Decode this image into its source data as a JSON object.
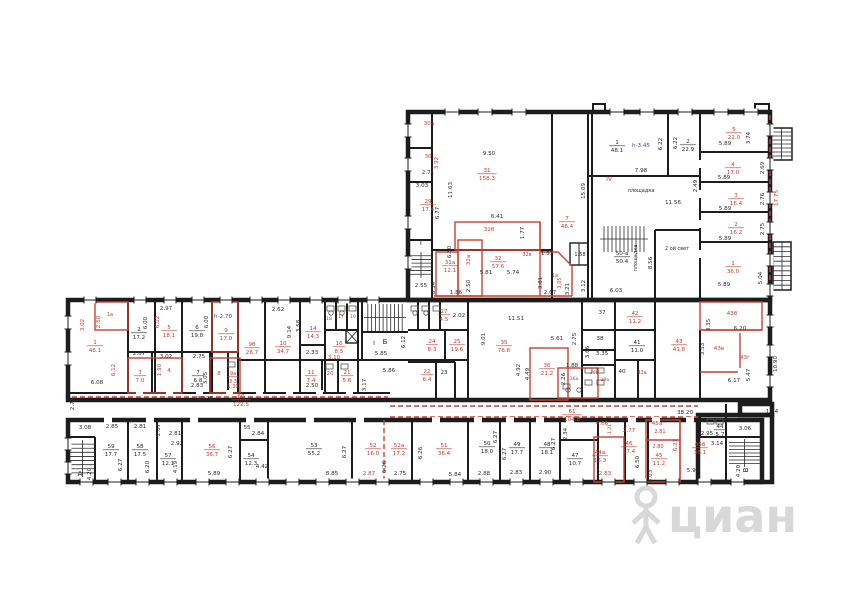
{
  "watermark": {
    "text": "циан"
  },
  "colors": {
    "ink": "#2b2b2b",
    "red": "#c23b2e",
    "blue": "#3f3fbf",
    "wall": "#1d1d1d",
    "watermark": "#d4d4d4"
  },
  "labels": [
    {
      "t": "30а",
      "x": 429,
      "y": 125,
      "c": "r"
    },
    {
      "t": "30",
      "x": 428,
      "y": 158,
      "c": "r"
    },
    {
      "t": "2.71",
      "x": 428,
      "y": 174
    },
    {
      "t": "3.92",
      "x": 438,
      "y": 163,
      "v": 1,
      "c": "r"
    },
    {
      "t": "3.03",
      "x": 422,
      "y": 187
    },
    {
      "t": "29",
      "a": "17.4",
      "x": 428,
      "y": 203,
      "c": "r"
    },
    {
      "t": "11.63",
      "x": 452,
      "y": 190,
      "v": 1
    },
    {
      "t": "6.77",
      "x": 439,
      "y": 213,
      "v": 1
    },
    {
      "t": "Г",
      "x": 422,
      "y": 245,
      "fs": 7
    },
    {
      "t": "6.50",
      "x": 451,
      "y": 252,
      "v": 1
    },
    {
      "t": "6.34",
      "x": 435,
      "y": 288,
      "v": 1
    },
    {
      "t": "2.55",
      "x": 421,
      "y": 287
    },
    {
      "t": "9.50",
      "x": 489,
      "y": 155
    },
    {
      "t": "31",
      "a": "158.3",
      "x": 487,
      "y": 172,
      "c": "r"
    },
    {
      "t": "32б",
      "x": 489,
      "y": 231,
      "c": "r"
    },
    {
      "t": "6.41",
      "x": 497,
      "y": 218
    },
    {
      "t": "1.77",
      "x": 524,
      "y": 233,
      "v": 1
    },
    {
      "t": "32а",
      "x": 470,
      "y": 260,
      "v": 1,
      "c": "r"
    },
    {
      "t": "31а",
      "a": "12.1",
      "x": 450,
      "y": 264,
      "c": "r"
    },
    {
      "t": "32",
      "a": "57.6",
      "x": 498,
      "y": 260,
      "c": "r"
    },
    {
      "t": "32в",
      "x": 527,
      "y": 256,
      "c": "r",
      "fs": 5
    },
    {
      "t": "5.81",
      "x": 486,
      "y": 274
    },
    {
      "t": "5.74",
      "x": 513,
      "y": 274
    },
    {
      "t": "2.50",
      "x": 470,
      "y": 286,
      "v": 1
    },
    {
      "t": "1.86",
      "x": 456,
      "y": 294
    },
    {
      "t": "1.31",
      "x": 547,
      "y": 255
    },
    {
      "t": "3.81",
      "x": 542,
      "y": 283,
      "v": 1
    },
    {
      "t": "2.67",
      "x": 550,
      "y": 294
    },
    {
      "t": "3.21",
      "x": 569,
      "y": 289,
      "v": 1
    },
    {
      "t": "1а",
      "x": 555,
      "y": 277,
      "c": "r",
      "fs": 5
    },
    {
      "t": "3.05",
      "x": 561,
      "y": 283,
      "v": 1,
      "c": "r",
      "fs": 5
    },
    {
      "t": "7",
      "a": "46.4",
      "x": 567,
      "y": 220,
      "c": "r"
    },
    {
      "t": "15.09",
      "x": 585,
      "y": 191,
      "v": 1
    },
    {
      "t": "1.58",
      "x": 580,
      "y": 256,
      "fs": 5
    },
    {
      "t": "3.12",
      "x": 585,
      "y": 286,
      "v": 1
    },
    {
      "t": "1",
      "a": "48.1",
      "x": 617,
      "y": 144
    },
    {
      "t": "h-3.45",
      "x": 641,
      "y": 147,
      "c": "b"
    },
    {
      "t": "6.22",
      "x": 662,
      "y": 144,
      "v": 1
    },
    {
      "t": "6.22",
      "x": 677,
      "y": 143,
      "v": 1
    },
    {
      "t": "2",
      "a": "22.9",
      "x": 688,
      "y": 143
    },
    {
      "t": "7.98",
      "x": 641,
      "y": 172
    },
    {
      "t": "IV",
      "x": 609,
      "y": 181,
      "c": "r",
      "fs": 6
    },
    {
      "t": "площадка",
      "x": 641,
      "y": 192,
      "fs": 5
    },
    {
      "t": "11.56",
      "x": 673,
      "y": 204
    },
    {
      "t": "2.49",
      "x": 697,
      "y": 186,
      "v": 1
    },
    {
      "t": "50-а",
      "a": "50.4",
      "x": 622,
      "y": 255
    },
    {
      "t": "площадка",
      "x": 637,
      "y": 258,
      "v": 1,
      "fs": 5
    },
    {
      "t": "8.56",
      "x": 652,
      "y": 263,
      "v": 1
    },
    {
      "t": "2 ой свет",
      "x": 677,
      "y": 250,
      "fs": 5
    },
    {
      "t": "6.03",
      "x": 616,
      "y": 292
    },
    {
      "t": "1",
      "a": "36.0",
      "x": 733,
      "y": 265,
      "c": "r"
    },
    {
      "t": "5.89",
      "x": 724,
      "y": 286
    },
    {
      "t": "5.04",
      "x": 762,
      "y": 278,
      "v": 1
    },
    {
      "t": "5",
      "a": "22.0",
      "x": 734,
      "y": 131,
      "c": "r"
    },
    {
      "t": "5.89",
      "x": 725,
      "y": 145
    },
    {
      "t": "3.74",
      "x": 750,
      "y": 138,
      "v": 1
    },
    {
      "t": "4",
      "a": "17.0",
      "x": 733,
      "y": 166,
      "c": "r"
    },
    {
      "t": "5.89",
      "x": 724,
      "y": 179
    },
    {
      "t": "2.69",
      "x": 764,
      "y": 168,
      "v": 1
    },
    {
      "t": "3",
      "a": "16.4",
      "x": 736,
      "y": 197,
      "c": "r"
    },
    {
      "t": "5.89",
      "x": 725,
      "y": 210
    },
    {
      "t": "2.76",
      "x": 764,
      "y": 199,
      "v": 1
    },
    {
      "t": "2",
      "a": "16.2",
      "x": 736,
      "y": 226,
      "c": "r"
    },
    {
      "t": "5.89",
      "x": 725,
      "y": 240
    },
    {
      "t": "2.75",
      "x": 764,
      "y": 229,
      "v": 1
    },
    {
      "t": "17.75",
      "x": 778,
      "y": 198,
      "v": 1,
      "c": "r"
    },
    {
      "t": "1а",
      "x": 110,
      "y": 316,
      "c": "r",
      "fs": 5
    },
    {
      "t": "3.02",
      "x": 84,
      "y": 325,
      "v": 1,
      "c": "r"
    },
    {
      "t": "2.50",
      "x": 100,
      "y": 322,
      "v": 1,
      "c": "r"
    },
    {
      "t": "1",
      "a": "46.1",
      "x": 95,
      "y": 344,
      "c": "r"
    },
    {
      "t": "2.97",
      "x": 166,
      "y": 310
    },
    {
      "t": "2",
      "a": "17.2",
      "x": 139,
      "y": 331
    },
    {
      "t": "6.00",
      "x": 147,
      "y": 323,
      "v": 1
    },
    {
      "t": "5",
      "a": "18.1",
      "x": 169,
      "y": 329,
      "c": "r"
    },
    {
      "t": "6.02",
      "x": 159,
      "y": 322,
      "v": 1,
      "c": "r"
    },
    {
      "t": "6",
      "a": "19.8",
      "x": 197,
      "y": 329
    },
    {
      "t": "6.00",
      "x": 208,
      "y": 322,
      "v": 1
    },
    {
      "t": "9",
      "a": "17.0",
      "x": 226,
      "y": 332,
      "c": "r"
    },
    {
      "t": "h-2.70",
      "x": 223,
      "y": 318,
      "c": "b"
    },
    {
      "t": "2.87",
      "x": 139,
      "y": 355
    },
    {
      "t": "3.02",
      "x": 166,
      "y": 358
    },
    {
      "t": "2.75",
      "x": 199,
      "y": 358
    },
    {
      "t": "6.12",
      "x": 115,
      "y": 370,
      "v": 1,
      "c": "r"
    },
    {
      "t": "3",
      "a": "7.0",
      "x": 140,
      "y": 374,
      "c": "r"
    },
    {
      "t": "4",
      "x": 169,
      "y": 372,
      "c": "r"
    },
    {
      "t": "1.90",
      "x": 161,
      "y": 370,
      "v": 1,
      "c": "r"
    },
    {
      "t": "7",
      "a": "6.8",
      "x": 198,
      "y": 374
    },
    {
      "t": "2.83",
      "x": 197,
      "y": 387
    },
    {
      "t": "3.05",
      "x": 207,
      "y": 378,
      "v": 1
    },
    {
      "t": "8",
      "x": 219,
      "y": 375,
      "c": "r"
    },
    {
      "t": "9а",
      "a": "3.3",
      "x": 233,
      "y": 375,
      "c": "r",
      "fs": 5
    },
    {
      "t": "1.30",
      "x": 233,
      "y": 388,
      "c": "r",
      "fs": 5
    },
    {
      "t": "6.08",
      "x": 97,
      "y": 384
    },
    {
      "t": "30.26",
      "x": 205,
      "y": 400
    },
    {
      "t": "2.71",
      "x": 74,
      "y": 404,
      "v": 1
    },
    {
      "t": "60",
      "a": "122.5",
      "x": 241,
      "y": 398,
      "c": "r"
    },
    {
      "t": "9б",
      "a": "26.7",
      "x": 252,
      "y": 346,
      "c": "r"
    },
    {
      "t": "10",
      "a": "34.7",
      "x": 283,
      "y": 345,
      "c": "r"
    },
    {
      "t": "2.62",
      "x": 278,
      "y": 311
    },
    {
      "t": "9.14",
      "x": 291,
      "y": 332,
      "v": 1
    },
    {
      "t": "3.58",
      "x": 300,
      "y": 326,
      "v": 1
    },
    {
      "t": "14",
      "a": "14.3",
      "x": 313,
      "y": 330,
      "c": "r"
    },
    {
      "t": "18",
      "x": 329,
      "y": 320,
      "c": "r",
      "fs": 4.5
    },
    {
      "t": "17",
      "x": 341,
      "y": 318,
      "c": "r",
      "fs": 4.5
    },
    {
      "t": "19",
      "x": 353,
      "y": 318,
      "c": "r",
      "fs": 4.5
    },
    {
      "t": "16",
      "a": "8.5",
      "x": 339,
      "y": 345,
      "c": "r"
    },
    {
      "t": "2.33",
      "x": 312,
      "y": 354
    },
    {
      "t": "3.10",
      "x": 334,
      "y": 359,
      "c": "r"
    },
    {
      "t": "11",
      "a": "7.4",
      "x": 311,
      "y": 374,
      "c": "r"
    },
    {
      "t": "2.50",
      "x": 312,
      "y": 387
    },
    {
      "t": "20",
      "x": 330,
      "y": 375,
      "c": "r"
    },
    {
      "t": "21",
      "a": "5.6",
      "x": 347,
      "y": 374,
      "c": "r"
    },
    {
      "t": "Б",
      "x": 385,
      "y": 344,
      "fs": 7
    },
    {
      "t": "I",
      "x": 374,
      "y": 345,
      "fs": 6
    },
    {
      "t": "6.12",
      "x": 405,
      "y": 342,
      "v": 1
    },
    {
      "t": "5.85",
      "x": 381,
      "y": 355
    },
    {
      "t": "5.86",
      "x": 389,
      "y": 372
    },
    {
      "t": "3.17",
      "x": 366,
      "y": 385,
      "v": 1
    },
    {
      "t": "27",
      "a": "4.5",
      "x": 444,
      "y": 313,
      "c": "r"
    },
    {
      "t": "2.02",
      "x": 459,
      "y": 317
    },
    {
      "t": "24",
      "a": "8.3",
      "x": 432,
      "y": 343,
      "c": "r"
    },
    {
      "t": "25",
      "a": "19.6",
      "x": 457,
      "y": 343,
      "c": "r"
    },
    {
      "t": "22",
      "a": "6.4",
      "x": 427,
      "y": 373,
      "c": "r"
    },
    {
      "t": "23",
      "x": 444,
      "y": 374
    },
    {
      "t": "35",
      "a": "76.8",
      "x": 504,
      "y": 344,
      "c": "r"
    },
    {
      "t": "11.51",
      "x": 516,
      "y": 320
    },
    {
      "t": "9.01",
      "x": 485,
      "y": 339,
      "v": 1
    },
    {
      "t": "5.61",
      "x": 557,
      "y": 340
    },
    {
      "t": "2.75",
      "x": 576,
      "y": 339,
      "v": 1
    },
    {
      "t": "37",
      "x": 602,
      "y": 314
    },
    {
      "t": "38",
      "x": 600,
      "y": 340
    },
    {
      "t": "3.66",
      "x": 589,
      "y": 352,
      "v": 1
    },
    {
      "t": "3.35",
      "x": 602,
      "y": 355
    },
    {
      "t": "36",
      "a": "21.2",
      "x": 547,
      "y": 367,
      "c": "r"
    },
    {
      "t": "4.92",
      "x": 520,
      "y": 370,
      "v": 1
    },
    {
      "t": "4.49",
      "x": 529,
      "y": 374,
      "v": 1
    },
    {
      "t": "1.88",
      "x": 572,
      "y": 367
    },
    {
      "t": "2.26",
      "x": 565,
      "y": 379,
      "v": 1
    },
    {
      "t": "36а",
      "x": 574,
      "y": 380,
      "c": "r",
      "fs": 4.5
    },
    {
      "t": "36б",
      "x": 594,
      "y": 374,
      "c": "r",
      "fs": 4.5
    },
    {
      "t": "39а",
      "x": 605,
      "y": 381,
      "c": "r",
      "fs": 4.5
    },
    {
      "t": "40",
      "x": 622,
      "y": 373
    },
    {
      "t": "41",
      "a": "11.0",
      "x": 637,
      "y": 344
    },
    {
      "t": "42",
      "a": "11.2",
      "x": 635,
      "y": 315,
      "c": "r"
    },
    {
      "t": "43",
      "a": "41.8",
      "x": 679,
      "y": 343,
      "c": "r"
    },
    {
      "t": "43а",
      "x": 642,
      "y": 374,
      "c": "r",
      "fs": 5
    },
    {
      "t": "43б",
      "x": 732,
      "y": 315,
      "c": "r"
    },
    {
      "t": "3.35",
      "x": 710,
      "y": 325,
      "v": 1
    },
    {
      "t": "6.20",
      "x": 740,
      "y": 330
    },
    {
      "t": "43в",
      "x": 719,
      "y": 350,
      "c": "r"
    },
    {
      "t": "3.53",
      "x": 704,
      "y": 349,
      "v": 1
    },
    {
      "t": "43г",
      "x": 745,
      "y": 359,
      "c": "r"
    },
    {
      "t": "6.17",
      "x": 734,
      "y": 382
    },
    {
      "t": "5.47",
      "x": 750,
      "y": 375,
      "v": 1
    },
    {
      "t": "10.90",
      "x": 777,
      "y": 364,
      "v": 1
    },
    {
      "t": "61",
      "a": "104.8",
      "x": 572,
      "y": 413,
      "c": "r"
    },
    {
      "t": "38.20",
      "x": 685,
      "y": 414
    },
    {
      "t": "1.54",
      "x": 772,
      "y": 413
    },
    {
      "t": "3.08",
      "x": 85,
      "y": 429
    },
    {
      "t": "2.85",
      "x": 112,
      "y": 428
    },
    {
      "t": "2.81",
      "x": 140,
      "y": 428
    },
    {
      "t": "2.07",
      "x": 160,
      "y": 430,
      "v": 1
    },
    {
      "t": "2.81",
      "x": 175,
      "y": 435
    },
    {
      "t": "2.92",
      "x": 177,
      "y": 445
    },
    {
      "t": "А",
      "x": 80,
      "y": 476,
      "fs": 7
    },
    {
      "t": "4.20",
      "x": 91,
      "y": 474,
      "v": 1
    },
    {
      "t": "59",
      "a": "17.7",
      "x": 111,
      "y": 448
    },
    {
      "t": "6.27",
      "x": 122,
      "y": 465,
      "v": 1
    },
    {
      "t": "58",
      "a": "17.5",
      "x": 140,
      "y": 448
    },
    {
      "t": "6.20",
      "x": 149,
      "y": 467,
      "v": 1
    },
    {
      "t": "57",
      "a": "12.1",
      "x": 168,
      "y": 457
    },
    {
      "t": "4.19",
      "x": 177,
      "y": 467,
      "v": 1
    },
    {
      "t": "56",
      "a": "36.7",
      "x": 212,
      "y": 448,
      "c": "r"
    },
    {
      "t": "6.27",
      "x": 232,
      "y": 452,
      "v": 1
    },
    {
      "t": "5.89",
      "x": 214,
      "y": 475
    },
    {
      "t": "55",
      "x": 247,
      "y": 429
    },
    {
      "t": "2.84",
      "x": 258,
      "y": 435
    },
    {
      "t": "54",
      "a": "12.3",
      "x": 251,
      "y": 457
    },
    {
      "t": "4.42",
      "x": 262,
      "y": 468
    },
    {
      "t": "53",
      "a": "55.2",
      "x": 314,
      "y": 447
    },
    {
      "t": "6.27",
      "x": 346,
      "y": 452,
      "v": 1
    },
    {
      "t": "8.85",
      "x": 332,
      "y": 475
    },
    {
      "t": "52",
      "a": "16.0",
      "x": 373,
      "y": 447,
      "c": "r"
    },
    {
      "t": "52а",
      "a": "17.2",
      "x": 399,
      "y": 447,
      "c": "r"
    },
    {
      "t": "6.26",
      "x": 386,
      "y": 467,
      "v": 1
    },
    {
      "t": "2.87",
      "x": 369,
      "y": 475,
      "c": "r"
    },
    {
      "t": "2.75",
      "x": 400,
      "y": 475
    },
    {
      "t": "51",
      "a": "36.4",
      "x": 444,
      "y": 447,
      "c": "r"
    },
    {
      "t": "6.26",
      "x": 422,
      "y": 453,
      "v": 1
    },
    {
      "t": "5.84",
      "x": 455,
      "y": 476
    },
    {
      "t": "50",
      "a": "18.0",
      "x": 487,
      "y": 445
    },
    {
      "t": "6.27",
      "x": 497,
      "y": 437,
      "v": 1
    },
    {
      "t": "2.88",
      "x": 484,
      "y": 475
    },
    {
      "t": "49",
      "a": "17.7",
      "x": 517,
      "y": 446
    },
    {
      "t": "6.27",
      "x": 506,
      "y": 454,
      "v": 1
    },
    {
      "t": "2.83",
      "x": 516,
      "y": 474
    },
    {
      "t": "48",
      "a": "18.1",
      "x": 547,
      "y": 446
    },
    {
      "t": "6.27",
      "x": 555,
      "y": 444,
      "v": 1
    },
    {
      "t": "2.90",
      "x": 545,
      "y": 474
    },
    {
      "t": "2.34",
      "x": 567,
      "y": 434,
      "v": 1
    },
    {
      "t": "47",
      "a": "10.7",
      "x": 575,
      "y": 457
    },
    {
      "t": "4.66",
      "x": 602,
      "y": 425,
      "c": "r"
    },
    {
      "t": "1.21",
      "x": 611,
      "y": 429,
      "v": 1,
      "c": "r",
      "fs": 4.5
    },
    {
      "t": "2.77",
      "x": 629,
      "y": 432,
      "c": "r"
    },
    {
      "t": "44а",
      "a": "13.3",
      "x": 600,
      "y": 454,
      "c": "r"
    },
    {
      "t": "2.83",
      "x": 605,
      "y": 475,
      "c": "r"
    },
    {
      "t": "46",
      "a": "17.4",
      "x": 629,
      "y": 445,
      "c": "r"
    },
    {
      "t": "6.50",
      "x": 639,
      "y": 462,
      "v": 1
    },
    {
      "t": "45а",
      "x": 657,
      "y": 425,
      "c": "r"
    },
    {
      "t": "2.81",
      "x": 660,
      "y": 433,
      "c": "r",
      "fs": 5
    },
    {
      "t": "2.80",
      "x": 658,
      "y": 448,
      "c": "r",
      "fs": 5
    },
    {
      "t": "45",
      "a": "11.2",
      "x": 659,
      "y": 457,
      "c": "r"
    },
    {
      "t": "6.21",
      "x": 677,
      "y": 445,
      "v": 1,
      "c": "r"
    },
    {
      "t": "45б",
      "a": "36.1",
      "x": 700,
      "y": 446,
      "c": "r"
    },
    {
      "t": "5.97",
      "x": 693,
      "y": 472
    },
    {
      "t": "4.03",
      "x": 652,
      "y": 476,
      "v": 1
    },
    {
      "t": "2.95",
      "x": 707,
      "y": 435
    },
    {
      "t": "44",
      "a": "5.7",
      "x": 720,
      "y": 428
    },
    {
      "t": "3.14",
      "x": 717,
      "y": 445
    },
    {
      "t": "3.06",
      "x": 745,
      "y": 430
    },
    {
      "t": "В",
      "x": 748,
      "y": 470,
      "v": 1,
      "fs": 7
    },
    {
      "t": "4.20",
      "x": 740,
      "y": 471,
      "v": 1
    }
  ]
}
